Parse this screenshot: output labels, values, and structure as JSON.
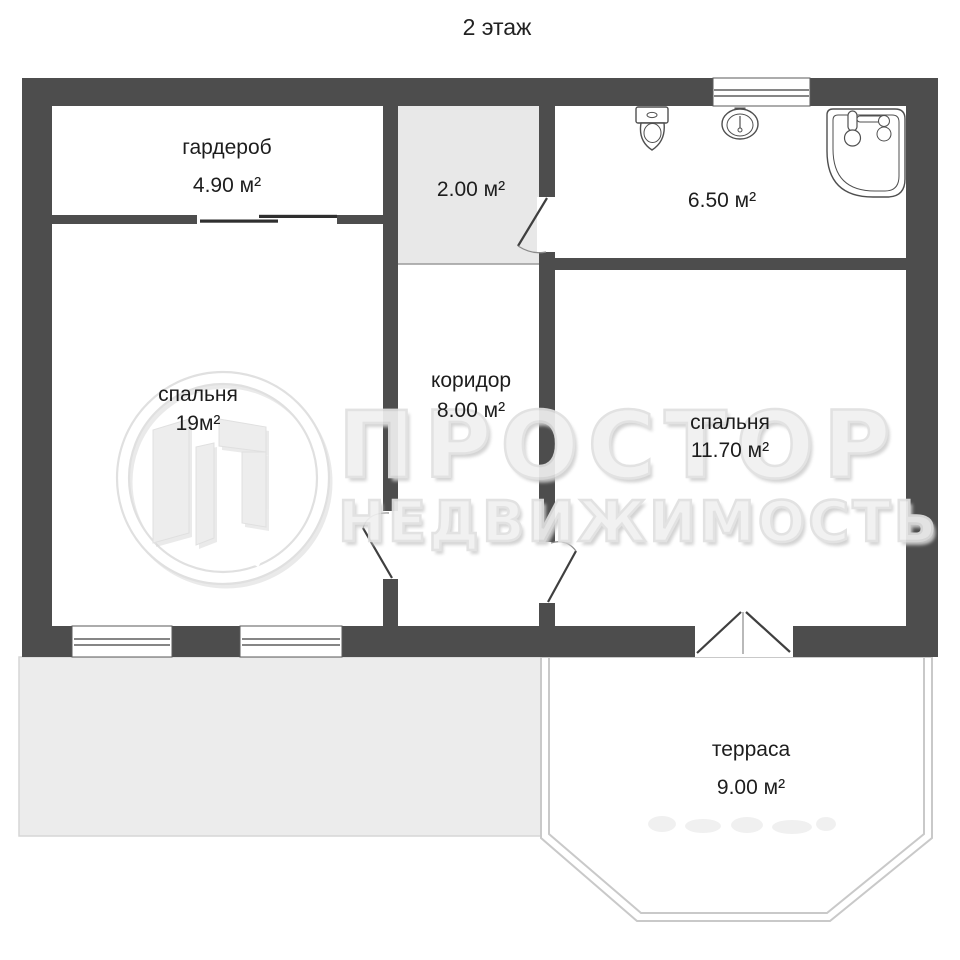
{
  "title": "2 этаж",
  "rooms": {
    "wardrobe": {
      "name": "гардероб",
      "area": "4.90 м²"
    },
    "vestibule": {
      "area": "2.00 м²"
    },
    "bathroom": {
      "area": "6.50 м²"
    },
    "bedroom_left": {
      "name": "спальня",
      "area": "19м²"
    },
    "corridor": {
      "name": "коридор",
      "area": "8.00 м²"
    },
    "bedroom_right": {
      "name": "спальня",
      "area": "11.70 м²"
    },
    "terrace": {
      "name": "терраса",
      "area": "9.00 м²"
    }
  },
  "watermark": {
    "brand": "ПРОСТОР",
    "subtitle": "НЕДВИЖИМОСТЬ",
    "logo": "prostor-logo-icon"
  },
  "icons": {
    "toilet": "toilet-icon",
    "sink": "sink-icon",
    "bathtub": "bathtub-icon"
  },
  "colors": {
    "wall": "#4d4d4d",
    "vestibule_fill": "#e8e8e8",
    "roof_fill": "#ececec",
    "terrace_outline": "#c9c9c9",
    "watermark": "#e2e2e2",
    "label_text": "#1d1d1d"
  }
}
